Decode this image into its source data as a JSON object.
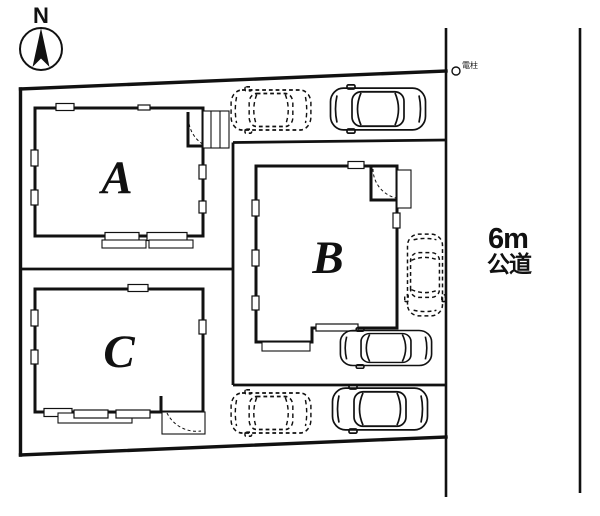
{
  "plan": {
    "title": "site-plan",
    "compass": {
      "label": "N"
    },
    "buildings": [
      {
        "id": "A",
        "label": "A"
      },
      {
        "id": "B",
        "label": "B"
      },
      {
        "id": "C",
        "label": "C"
      }
    ],
    "road": {
      "width_label": "6m",
      "type_label": "公道"
    },
    "pole": {
      "label": "電柱"
    },
    "parking": {
      "dashed_spaces_count": 3,
      "solid_cars_count": 3
    },
    "colors": {
      "line": "#111111",
      "background": "#ffffff"
    }
  }
}
